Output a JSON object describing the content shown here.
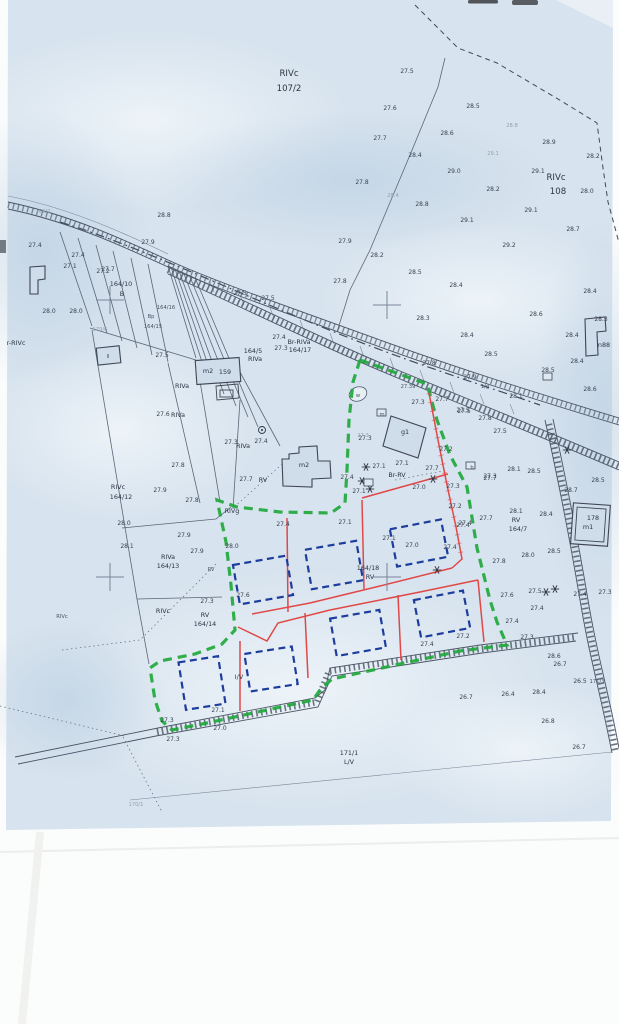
{
  "document": {
    "type": "scanned cadastral site plan",
    "site_boundary_color": "#1fa83c",
    "proposed_lot_color": "#e04848",
    "proposed_building_color": "#1d3d9c",
    "paper_color": "#d7e3ee"
  },
  "map": {
    "labels": [
      {
        "t": "RIVc",
        "x": 289,
        "y": 76,
        "k": "b"
      },
      {
        "t": "107/2",
        "x": 289,
        "y": 91,
        "k": "b"
      },
      {
        "t": "RIVc",
        "x": 556,
        "y": 180,
        "k": "b"
      },
      {
        "t": "108",
        "x": 558,
        "y": 194,
        "k": "b"
      },
      {
        "t": "27.5",
        "x": 407,
        "y": 73
      },
      {
        "t": "27.6",
        "x": 390,
        "y": 110
      },
      {
        "t": "28.5",
        "x": 473,
        "y": 108
      },
      {
        "t": "27.7",
        "x": 380,
        "y": 140
      },
      {
        "t": "28.4",
        "x": 415,
        "y": 157
      },
      {
        "t": "28.6",
        "x": 447,
        "y": 135
      },
      {
        "t": "28.8",
        "x": 512,
        "y": 127,
        "k": "f"
      },
      {
        "t": "28.9",
        "x": 549,
        "y": 144
      },
      {
        "t": "28.2",
        "x": 593,
        "y": 158
      },
      {
        "t": "29.1",
        "x": 493,
        "y": 155,
        "k": "f"
      },
      {
        "t": "29.0",
        "x": 454,
        "y": 173
      },
      {
        "t": "29.1",
        "x": 538,
        "y": 173
      },
      {
        "t": "28.0",
        "x": 587,
        "y": 193
      },
      {
        "t": "28.2",
        "x": 493,
        "y": 191
      },
      {
        "t": "29.1",
        "x": 531,
        "y": 212
      },
      {
        "t": "29.1",
        "x": 467,
        "y": 222
      },
      {
        "t": "28.8",
        "x": 422,
        "y": 206
      },
      {
        "t": "28.7",
        "x": 573,
        "y": 231
      },
      {
        "t": "27.8",
        "x": 362,
        "y": 184
      },
      {
        "t": "28.4",
        "x": 393,
        "y": 197,
        "k": "f"
      },
      {
        "t": "27.9",
        "x": 345,
        "y": 243
      },
      {
        "t": "28.2",
        "x": 377,
        "y": 257
      },
      {
        "t": "28.5",
        "x": 415,
        "y": 274
      },
      {
        "t": "27.8",
        "x": 340,
        "y": 283
      },
      {
        "t": "28.4",
        "x": 456,
        "y": 287
      },
      {
        "t": "29.2",
        "x": 509,
        "y": 247
      },
      {
        "t": "27.4",
        "x": 35,
        "y": 247
      },
      {
        "t": "27.4",
        "x": 78,
        "y": 257
      },
      {
        "t": "27.1",
        "x": 70,
        "y": 268
      },
      {
        "t": "27.7",
        "x": 108,
        "y": 271
      },
      {
        "t": "28.0",
        "x": 49,
        "y": 313
      },
      {
        "t": "28.0",
        "x": 76,
        "y": 313
      },
      {
        "t": "28.8",
        "x": 164,
        "y": 217
      },
      {
        "t": "27.9",
        "x": 148,
        "y": 244
      },
      {
        "t": "166/2",
        "x": 43,
        "y": 213,
        "k": "f"
      },
      {
        "t": "164/10",
        "x": 121,
        "y": 286,
        "k": "p"
      },
      {
        "t": "B",
        "x": 122,
        "y": 296,
        "k": "p"
      },
      {
        "t": "179/6",
        "x": 100,
        "y": 331,
        "k": "f"
      },
      {
        "t": "27.2",
        "x": 103,
        "y": 273
      },
      {
        "t": "27.5",
        "x": 240,
        "y": 295
      },
      {
        "t": "27.5",
        "x": 268,
        "y": 300
      },
      {
        "t": "Bp",
        "x": 151,
        "y": 318,
        "k": "s"
      },
      {
        "t": "164/15",
        "x": 153,
        "y": 328,
        "k": "s"
      },
      {
        "t": "164/16",
        "x": 166,
        "y": 309,
        "k": "s"
      },
      {
        "t": "27.5",
        "x": 162,
        "y": 357
      },
      {
        "t": "28.3",
        "x": 423,
        "y": 320
      },
      {
        "t": "28.4",
        "x": 467,
        "y": 337
      },
      {
        "t": "28.6",
        "x": 536,
        "y": 316
      },
      {
        "t": "28.4",
        "x": 590,
        "y": 293
      },
      {
        "t": "28.5",
        "x": 491,
        "y": 356
      },
      {
        "t": "27.8",
        "x": 429,
        "y": 365
      },
      {
        "t": "27.9",
        "x": 470,
        "y": 379
      },
      {
        "t": "27.5",
        "x": 464,
        "y": 413
      },
      {
        "t": "27.5",
        "x": 500,
        "y": 433
      },
      {
        "t": "28.1",
        "x": 516,
        "y": 398
      },
      {
        "t": "1/g",
        "x": 485,
        "y": 388,
        "k": "s"
      },
      {
        "t": "28.3",
        "x": 601,
        "y": 321
      },
      {
        "t": "28.4",
        "x": 572,
        "y": 337
      },
      {
        "t": "28.4",
        "x": 577,
        "y": 363
      },
      {
        "t": "28.5",
        "x": 548,
        "y": 372
      },
      {
        "t": "28.6",
        "x": 590,
        "y": 391
      },
      {
        "t": "n88",
        "x": 604,
        "y": 347,
        "k": "p"
      },
      {
        "t": "Br-RIVa",
        "x": 299,
        "y": 344,
        "k": "p"
      },
      {
        "t": "164/17",
        "x": 300,
        "y": 352,
        "k": "p"
      },
      {
        "t": "164/5",
        "x": 253,
        "y": 353,
        "k": "p"
      },
      {
        "t": "RIVa",
        "x": 255,
        "y": 361,
        "k": "p"
      },
      {
        "t": "27.4",
        "x": 279,
        "y": 339
      },
      {
        "t": "27.3",
        "x": 281,
        "y": 350
      },
      {
        "t": "m2",
        "x": 208,
        "y": 373,
        "k": "p"
      },
      {
        "t": "159",
        "x": 225,
        "y": 374,
        "k": "p"
      },
      {
        "t": "RIVa",
        "x": 182,
        "y": 388,
        "k": "p"
      },
      {
        "t": "RIVa",
        "x": 178,
        "y": 417,
        "k": "p"
      },
      {
        "t": "27.6",
        "x": 163,
        "y": 416
      },
      {
        "t": "27.8",
        "x": 178,
        "y": 467
      },
      {
        "t": "27.3",
        "x": 231,
        "y": 444
      },
      {
        "t": "RIVa",
        "x": 243,
        "y": 448,
        "k": "p"
      },
      {
        "t": "27.4",
        "x": 261,
        "y": 443
      },
      {
        "t": "RV",
        "x": 263,
        "y": 482,
        "k": "p"
      },
      {
        "t": "27.7",
        "x": 246,
        "y": 481
      },
      {
        "t": "m2",
        "x": 304,
        "y": 467,
        "k": "p"
      },
      {
        "t": "w",
        "x": 358,
        "y": 397,
        "k": "s"
      },
      {
        "t": "27.39",
        "x": 408,
        "y": 388,
        "k": "s"
      },
      {
        "t": "27.3",
        "x": 418,
        "y": 404
      },
      {
        "t": "27.5",
        "x": 463,
        "y": 412
      },
      {
        "t": "27.8",
        "x": 485,
        "y": 420
      },
      {
        "t": "27.3",
        "x": 365,
        "y": 440
      },
      {
        "t": "g1",
        "x": 405,
        "y": 434,
        "k": "p"
      },
      {
        "t": "27.3",
        "x": 363,
        "y": 437,
        "k": "f"
      },
      {
        "t": "27.2",
        "x": 446,
        "y": 451
      },
      {
        "t": "27.1",
        "x": 402,
        "y": 465
      },
      {
        "t": "Br-RV",
        "x": 397,
        "y": 477,
        "k": "p"
      },
      {
        "t": "27.1",
        "x": 379,
        "y": 468
      },
      {
        "t": "27.7",
        "x": 432,
        "y": 470
      },
      {
        "t": "27.3",
        "x": 490,
        "y": 478
      },
      {
        "t": "27.4",
        "x": 347,
        "y": 479
      },
      {
        "t": "27.7",
        "x": 442,
        "y": 401
      },
      {
        "t": "m",
        "x": 382,
        "y": 416,
        "k": "s"
      },
      {
        "t": "b",
        "x": 472,
        "y": 469,
        "k": "s"
      },
      {
        "t": "RIVg",
        "x": 232,
        "y": 513,
        "k": "p"
      },
      {
        "t": "27.8",
        "x": 192,
        "y": 502
      },
      {
        "t": "27.9",
        "x": 160,
        "y": 492
      },
      {
        "t": "28.0",
        "x": 124,
        "y": 525
      },
      {
        "t": "28.1",
        "x": 127,
        "y": 548
      },
      {
        "t": "27.9",
        "x": 184,
        "y": 537
      },
      {
        "t": "27.9",
        "x": 197,
        "y": 553
      },
      {
        "t": "RIVa",
        "x": 168,
        "y": 559,
        "k": "p"
      },
      {
        "t": "164/13",
        "x": 168,
        "y": 568,
        "k": "p"
      },
      {
        "t": "RV",
        "x": 211,
        "y": 571,
        "k": "s"
      },
      {
        "t": "28.0",
        "x": 232,
        "y": 548
      },
      {
        "t": "27.4",
        "x": 283,
        "y": 526
      },
      {
        "t": "27.1",
        "x": 345,
        "y": 524
      },
      {
        "t": "27.1",
        "x": 359,
        "y": 493
      },
      {
        "t": "27.0",
        "x": 419,
        "y": 489
      },
      {
        "t": "27.3",
        "x": 453,
        "y": 488
      },
      {
        "t": "27.2",
        "x": 455,
        "y": 508
      },
      {
        "t": "27.1",
        "x": 389,
        "y": 540
      },
      {
        "t": "27.0",
        "x": 412,
        "y": 547
      },
      {
        "t": "27.4",
        "x": 450,
        "y": 549
      },
      {
        "t": "27.4",
        "x": 463,
        "y": 527
      },
      {
        "t": "164/18",
        "x": 368,
        "y": 570,
        "k": "p"
      },
      {
        "t": "RV",
        "x": 370,
        "y": 579,
        "k": "p"
      },
      {
        "t": "27.3",
        "x": 207,
        "y": 603
      },
      {
        "t": "RIVc",
        "x": 163,
        "y": 613,
        "k": "p"
      },
      {
        "t": "RV",
        "x": 205,
        "y": 617,
        "k": "p"
      },
      {
        "t": "164/14",
        "x": 205,
        "y": 626,
        "k": "p"
      },
      {
        "t": "RIVc",
        "x": 118,
        "y": 489,
        "k": "p"
      },
      {
        "t": "164/12",
        "x": 121,
        "y": 499,
        "k": "p"
      },
      {
        "t": "27.6",
        "x": 243,
        "y": 597
      },
      {
        "t": "I/V",
        "x": 239,
        "y": 679,
        "k": "p"
      },
      {
        "t": "27.1",
        "x": 218,
        "y": 712
      },
      {
        "t": "27.3",
        "x": 167,
        "y": 722
      },
      {
        "t": "27.0",
        "x": 220,
        "y": 730
      },
      {
        "t": "27.3",
        "x": 173,
        "y": 741
      },
      {
        "t": "27.2",
        "x": 463,
        "y": 638
      },
      {
        "t": "27.4",
        "x": 427,
        "y": 646
      },
      {
        "t": "171/1",
        "x": 349,
        "y": 755,
        "k": "p"
      },
      {
        "t": "L/V",
        "x": 349,
        "y": 764,
        "k": "p"
      },
      {
        "t": "26.7",
        "x": 466,
        "y": 699
      },
      {
        "t": "170/1",
        "x": 136,
        "y": 806,
        "k": "f"
      },
      {
        "t": "27.7",
        "x": 490,
        "y": 480
      },
      {
        "t": "28.1",
        "x": 514,
        "y": 471
      },
      {
        "t": "28.5",
        "x": 534,
        "y": 473
      },
      {
        "t": "28.5",
        "x": 598,
        "y": 482
      },
      {
        "t": "28.7",
        "x": 571,
        "y": 492
      },
      {
        "t": "27.7",
        "x": 486,
        "y": 520
      },
      {
        "t": "27.4",
        "x": 465,
        "y": 525
      },
      {
        "t": "28.1",
        "x": 516,
        "y": 513
      },
      {
        "t": "RV",
        "x": 516,
        "y": 522,
        "k": "p"
      },
      {
        "t": "164/7",
        "x": 518,
        "y": 531,
        "k": "p"
      },
      {
        "t": "28.4",
        "x": 546,
        "y": 516
      },
      {
        "t": "178",
        "x": 593,
        "y": 520,
        "k": "p"
      },
      {
        "t": "m1",
        "x": 588,
        "y": 529,
        "k": "p"
      },
      {
        "t": "28.0",
        "x": 528,
        "y": 557
      },
      {
        "t": "28.5",
        "x": 554,
        "y": 553
      },
      {
        "t": "27.8",
        "x": 499,
        "y": 563
      },
      {
        "t": "27.6",
        "x": 507,
        "y": 597
      },
      {
        "t": "27.5",
        "x": 535,
        "y": 593
      },
      {
        "t": "27.4",
        "x": 537,
        "y": 610
      },
      {
        "t": "27.3",
        "x": 605,
        "y": 594
      },
      {
        "t": "27.4",
        "x": 580,
        "y": 596
      },
      {
        "t": "27.4",
        "x": 512,
        "y": 623
      },
      {
        "t": "27.3",
        "x": 527,
        "y": 639
      },
      {
        "t": "28.6",
        "x": 554,
        "y": 658
      },
      {
        "t": "26.7",
        "x": 560,
        "y": 666
      },
      {
        "t": "26.5",
        "x": 580,
        "y": 683
      },
      {
        "t": "171/3",
        "x": 597,
        "y": 683,
        "k": "s"
      },
      {
        "t": "28.4",
        "x": 539,
        "y": 694
      },
      {
        "t": "26.4",
        "x": 508,
        "y": 696
      },
      {
        "t": "26.8",
        "x": 548,
        "y": 723
      },
      {
        "t": "26.7",
        "x": 579,
        "y": 749
      },
      {
        "t": "r-RIVc",
        "x": 16,
        "y": 345,
        "k": "p"
      },
      {
        "t": "RIVc",
        "x": 62,
        "y": 618,
        "k": "s"
      },
      {
        "t": "II",
        "x": 108,
        "y": 358,
        "k": "s"
      }
    ],
    "symbols": {
      "grid_crosses": [
        [
          110,
          300
        ],
        [
          387,
          305
        ],
        [
          110,
          577
        ],
        [
          387,
          577
        ]
      ],
      "tree_stars": [
        [
          362,
          481
        ],
        [
          370,
          489
        ],
        [
          366,
          467
        ],
        [
          433,
          479
        ],
        [
          555,
          589
        ],
        [
          567,
          450
        ],
        [
          437,
          570
        ],
        [
          546,
          592
        ]
      ],
      "utility_boxes": [
        [
          377,
          409
        ],
        [
          466,
          462
        ],
        [
          543,
          373
        ],
        [
          364,
          479
        ]
      ],
      "circle_marks": [
        [
          262,
          430
        ]
      ]
    }
  }
}
